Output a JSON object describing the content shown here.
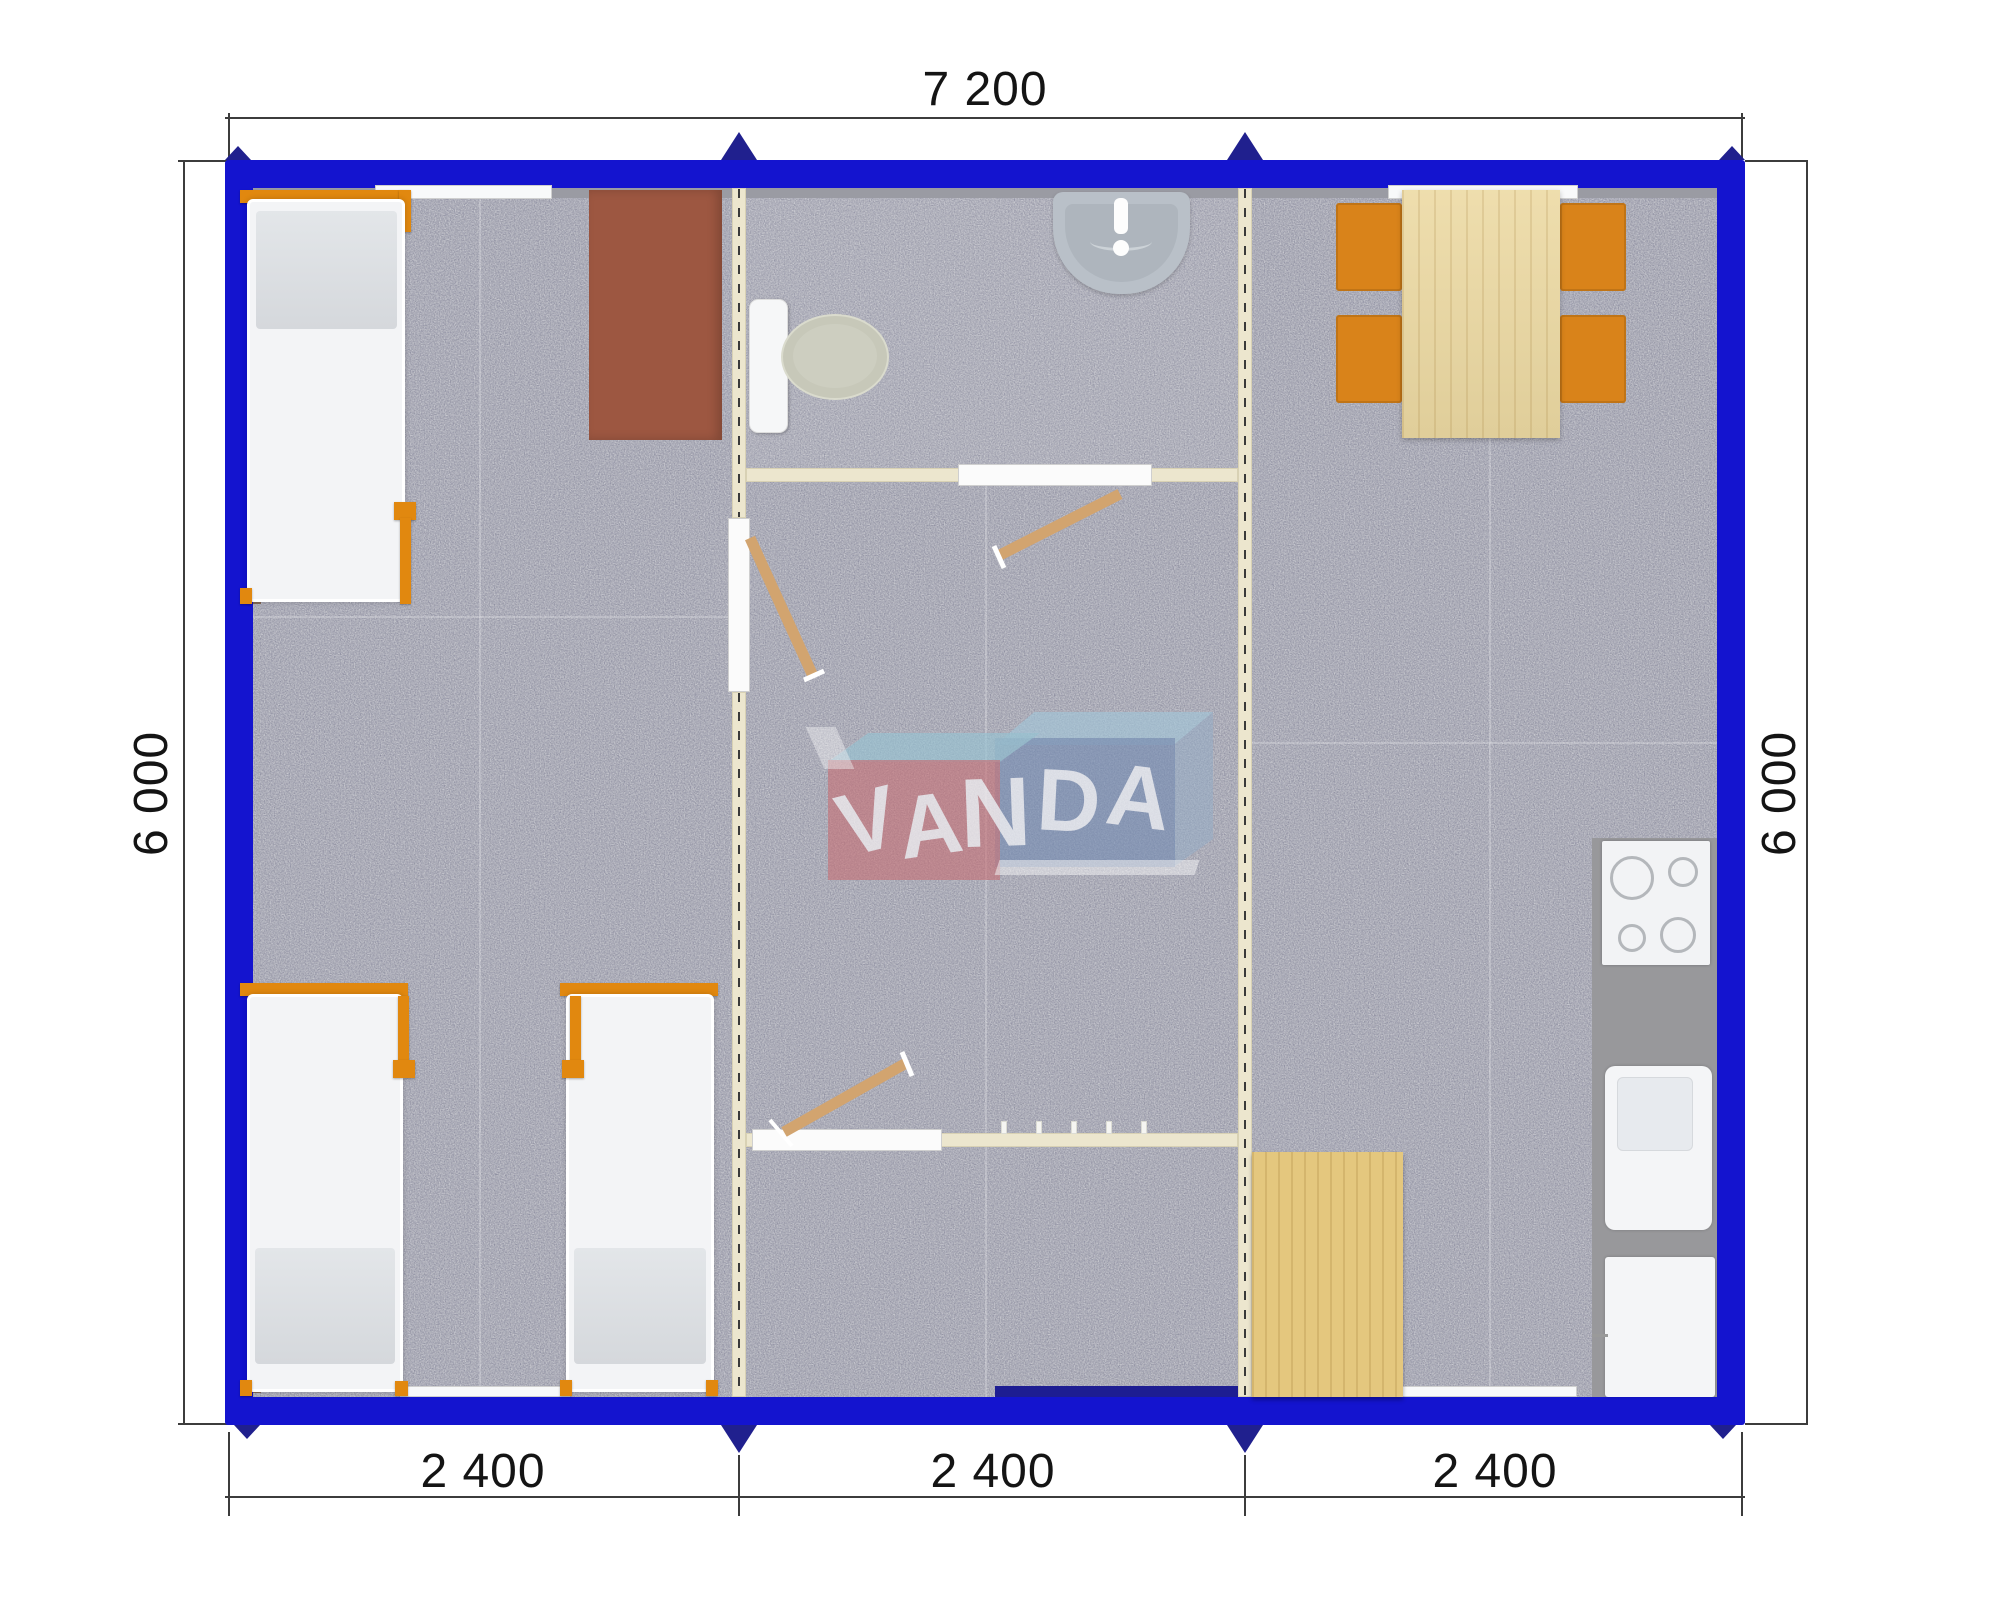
{
  "title": "VANDA modular house floor plan 7.2 x 6.0 m",
  "dimensions": {
    "top": "7 200",
    "left": "6 000",
    "right": "6 000",
    "bottom": [
      "2 400",
      "2 400",
      "2 400"
    ]
  },
  "logo": {
    "name": "VANDA",
    "letters": [
      "V",
      "A",
      "N",
      "D",
      "A"
    ]
  },
  "colors": {
    "outer_wall_blue": "#1414cf",
    "joint_marker_navy": "#20208e",
    "carpet_gray": "#adaeb6",
    "partition_cream": "#ece6ce",
    "furniture_orange": "#d9831a",
    "bed_frame_orange": "#e1880f",
    "desk_brown": "#9d5741",
    "table_wood": "#ecd9a2",
    "mat_wood": "#e4c77e",
    "counter_gray": "#98989b",
    "logo_pink": "#c66e74",
    "logo_blue": "#748cb2"
  },
  "rooms": {
    "left_module": [
      "single-bed",
      "desk",
      "single-bed",
      "single-bed"
    ],
    "middle_module": [
      "bathroom-sink",
      "toilet",
      "interior-doors",
      "entrance"
    ],
    "right_module": [
      "dining-table",
      "four-chairs",
      "cooktop",
      "kitchen-sink",
      "kitchen-cabinet",
      "wood-mat"
    ]
  }
}
